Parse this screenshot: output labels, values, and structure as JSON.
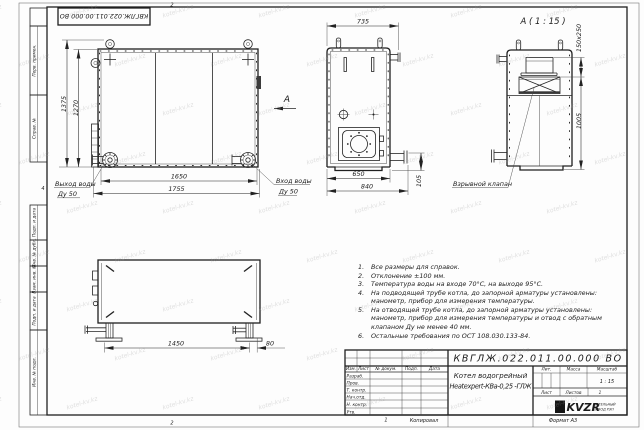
{
  "watermark": {
    "text": "kotel-kv.kz"
  },
  "sheet": {
    "doc_number_inverted": "КВГЛЖ.022.011.00.000 ВО",
    "zone_top": "2",
    "zone_bottom": "2",
    "zone_bottom_left": "1",
    "zone_left": "4",
    "copied": "Копировал",
    "format": "Формат А3",
    "left_stamps": [
      "Перв. примен.",
      "Справ. №",
      "Подп. и дата",
      "Инв. № дубл.",
      "Взам. инв. №",
      "Подп. и дата",
      "Инв. № подл."
    ]
  },
  "front_view": {
    "dim_height_outer": "1375",
    "dim_height_inner": "1270",
    "dim_width_inner": "1650",
    "dim_width_outer": "1755",
    "outlet_line1": "Выход воды",
    "outlet_line2": "Ду 50",
    "inlet_line1": "Вход воды",
    "inlet_line2": "Ду 50",
    "view_arrow": "А"
  },
  "side_view": {
    "dim_top": "735",
    "dim_bottom_inner": "650",
    "dim_bottom_outer": "840",
    "dim_pipe": "105"
  },
  "detail_view": {
    "title": "А ( 1 : 15 )",
    "dim_valve": "150x250",
    "dim_height": "1005",
    "valve_label": "Взрывной клапан"
  },
  "bottom_view": {
    "dim_legs": "1450",
    "dim_offset": "80"
  },
  "notes": [
    {
      "num": "1.",
      "text": "Все размеры для справок."
    },
    {
      "num": "2.",
      "text": "Отклонение ±100 мм."
    },
    {
      "num": "3.",
      "text": "Температура воды на входе 70°С, на выходе 95°С."
    },
    {
      "num": "4.",
      "text": "На подводящей трубе котла, до запорной арматуры установлены:\nманометр, прибор для измерения температуры."
    },
    {
      "num": "5.",
      "text": "На отводящей трубе котла, до запорной арматуры установлены:\nманометр, прибор для измерения температуры и отвод с обратным\nклапаном Ду не менее 40 мм."
    },
    {
      "num": "6.",
      "text": "Остальные требования по ОСТ 108.030.133-84."
    }
  ],
  "title_block": {
    "doc_number": "КВГЛЖ.022.011.00.000 ВО",
    "product_line1": "Котел водогрейный",
    "product_line2": "Heatexpert-КВа-0,25 -ГЛЖ",
    "col_izm": "Изм.",
    "col_list": "Лист",
    "col_doc": "№ докум.",
    "col_sign": "Подп.",
    "col_date": "Дата",
    "rows": [
      "Разраб.",
      "Пров.",
      "Т. контр.",
      "Нач.отд.",
      "Н. контр.",
      "Утв."
    ],
    "lit": "Лит.",
    "mass": "Масса",
    "scale": "Масштаб",
    "scale_value": "1 : 15",
    "sheet": "Лист",
    "sheets": "Листов",
    "sheets_value": "1",
    "logo": "KVZR",
    "company1": "КОТЕЛЬНЫЙ",
    "company2": "ЗАВОД РЭП"
  }
}
